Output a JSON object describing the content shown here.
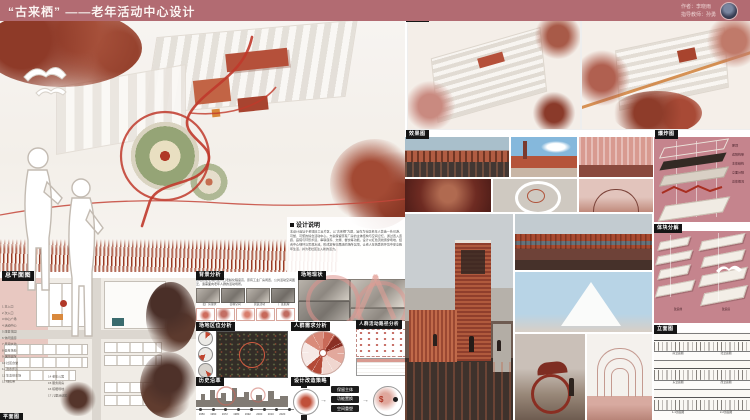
{
  "palette": {
    "header_bg": "#b26b72",
    "panel_pink": "#c5848d",
    "accent_red": "#b03a2a",
    "chip_bg": "#151515"
  },
  "header": {
    "title": "“古来栖” ——老年活动中心设计",
    "author": "作者：李晓雨",
    "advisor": "指导教师：孙勇"
  },
  "notes": {
    "label": "设计说明",
    "body": "本设计选址于老城旧工业片区，以“古来栖”为题，旨在为社区老年人营造一处可游、可憩、可聚的综合活动中心。方案保留原有厂房的主体结构与空间记忆，通过置入连廊、庭院与环形步道，串联康养、文娱、餐饮等功能。设计以红色流线贯穿场地，结合中心绿环与景观水池，形成富有归属感的场所氛围，让老人在熟悉的环境中安享晚年生活，并为老社区注入新的活力。"
  },
  "site_plan": {
    "label": "总平面图",
    "footer_label": "平面图",
    "legend": [
      "1 主入口",
      "2 次入口",
      "3 中心广场",
      "4 活动中心",
      "5 康复花园",
      "6 休闲连廊",
      "7 景观水池",
      "8 健身场地",
      "9 棋牌庭院",
      "10 社区食堂",
      "11 滨水步道",
      "12 生态停车场",
      "13 绿化带",
      "14 老年公寓",
      "15 服务用房",
      "16 晾晒场地",
      "17 儿童活动区"
    ]
  },
  "background": {
    "label": "背景分析",
    "intro": "基地所在老城片区人口老龄化程度高，原有工业厂房闲置，公共活动空间匮乏，亟需面向老年人群的活动场所。",
    "captions": [
      "旧厂房现状",
      "街巷空间",
      "居民活动",
      "厂区肌理"
    ]
  },
  "site_status": {
    "label": "场地现状"
  },
  "location": {
    "label": "场地区位分析"
  },
  "demand": {
    "label": "人群需求分析"
  },
  "paths": {
    "label": "人群活动路径分析"
  },
  "history": {
    "label": "历史沿革",
    "years": [
      "1950",
      "1960",
      "1972",
      "1980",
      "1992",
      "2000",
      "2010",
      "2020"
    ]
  },
  "strategy": {
    "label": "设计改造策略",
    "steps": [
      "保留主体",
      "功能置换",
      "空间重塑"
    ]
  },
  "birdseye": {
    "label": "鸟瞰图"
  },
  "renders": {
    "label": "效果图"
  },
  "exploded": {
    "label": "爆炸图",
    "layers": [
      "屋顶",
      "遮阳构架",
      "主体结构",
      "立面分隔",
      "总体概况"
    ]
  },
  "massing": {
    "label": "体块分解",
    "captions": [
      "改造前",
      "改造后"
    ]
  },
  "elevations": {
    "label": "立面图",
    "captions": [
      "南立面图",
      "北立面图",
      "东立面图",
      "西立面图",
      "1-1剖面图",
      "2-2剖面图"
    ]
  }
}
